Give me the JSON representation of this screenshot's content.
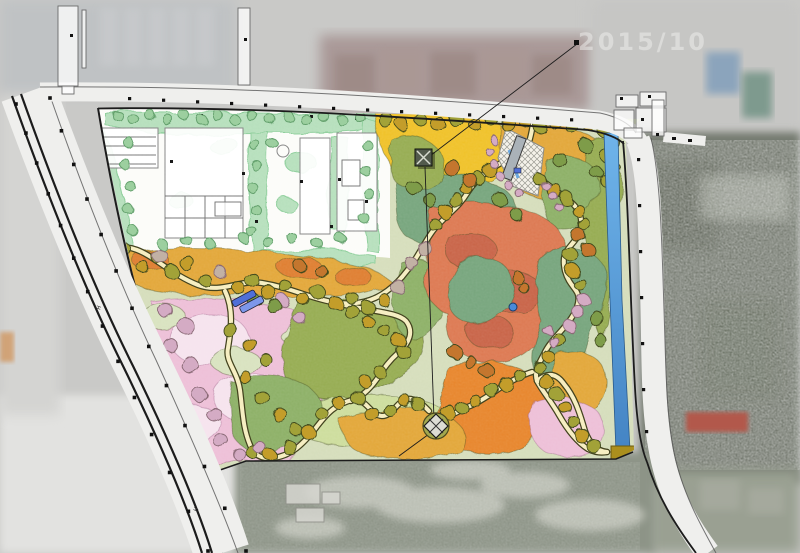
{
  "watermark": {
    "text": "2015/10"
  },
  "road_marks": {
    "glyph": "H"
  },
  "palette": {
    "aerial_base": "#c9c9c7",
    "aerial_blocks": "#bfc2c4",
    "aerial_brown": "#a49190",
    "aerial_topright": "#c6c6c4",
    "aerial_dark_trees": "#747a6f",
    "aerial_field": "#8d9487",
    "aerial_light": "#e2e2e0",
    "aerial_leftmid": "#d4d4d2",
    "aerial_bottomright": "#9aa092",
    "blue_roof": "#8ba4bc",
    "green_roof": "#7e9a8e",
    "red_roof": "#b2584c",
    "orange_patch": "#d08a48",
    "road": "#efefed",
    "road_line": "#1c1c1c",
    "ink": "#1c1c1c",
    "park_base": "#d6debc",
    "white_zone": "#fcfcf9",
    "mint": "#b7e0bd",
    "mint_dark": "#8fcf9c",
    "yellow": "#f0c22c",
    "gold": "#e3a83b",
    "orange": "#df7f33",
    "orange2": "#e8872d",
    "salmon": "#dd7a52",
    "terra": "#c96549",
    "teal": "#78a67e",
    "olivegreen": "#97ad52",
    "green2": "#8eb168",
    "palegreen": "#cede9e",
    "sage": "#d9e3c0",
    "pink": "#eec0d8",
    "palepink": "#f6e4ee",
    "water": "#6fb4ea",
    "water_dark": "#4484c4",
    "weir": "#ab8f1d",
    "tree_olive": "#a2a238",
    "tree_gold": "#c39d2c",
    "tree_orange": "#c4762f",
    "tree_pink": "#d4abc4",
    "tree_tan": "#c2b1a4",
    "tree_mint": "#9ccf9f",
    "tree_green": "#7e9c4a",
    "path_fill": "#f6eec2",
    "path_edge": "#43431f",
    "pavilion": "#525a4c",
    "pavilion_x": "#d8dcd0",
    "plaza_olive": "#a3a84e",
    "blue_building": "#4f6fd8",
    "blue_building2": "#7d97ea",
    "bridge": "#aab2b8",
    "watermark_color": "#f0f0ee",
    "pond": "#4a8ad8"
  }
}
